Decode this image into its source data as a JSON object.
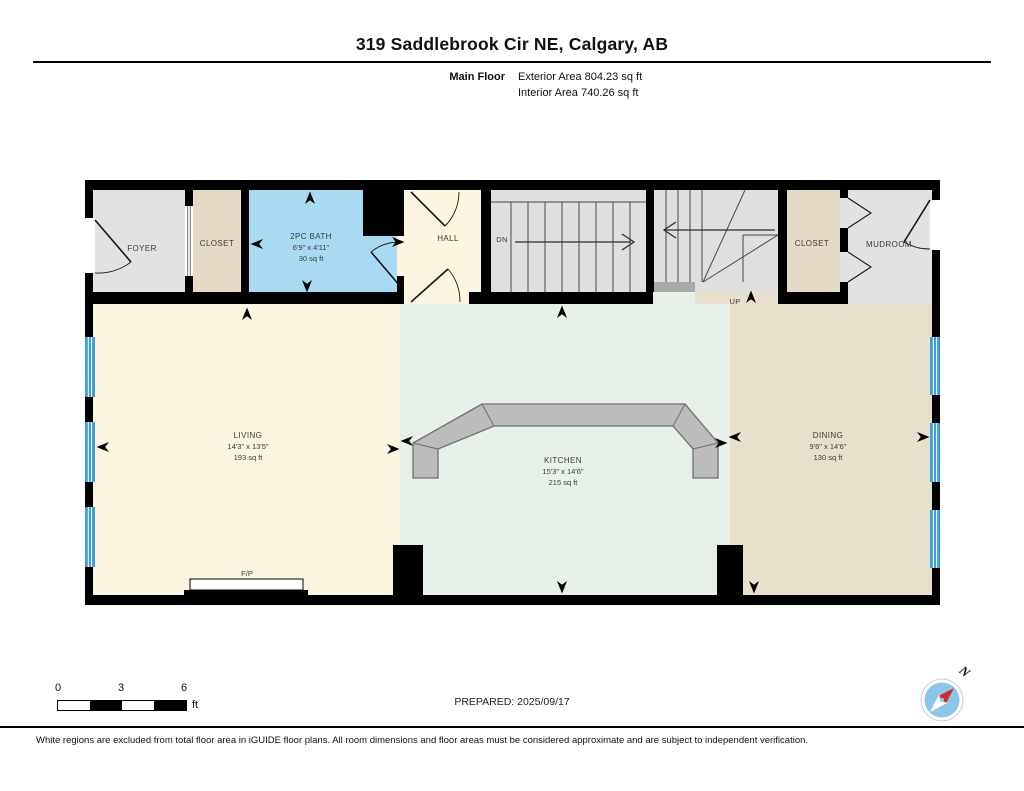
{
  "header": {
    "title": "319 Saddlebrook Cir NE, Calgary, AB",
    "floor_label": "Main Floor",
    "exterior_area": "Exterior Area 804.23 sq ft",
    "interior_area": "Interior Area 740.26 sq ft"
  },
  "rooms": {
    "foyer": {
      "label": "FOYER"
    },
    "closet_left": {
      "label": "CLOSET"
    },
    "bath": {
      "label": "2PC BATH",
      "dims": "6'9\" x 4'11\"",
      "area": "30 sq ft"
    },
    "hall": {
      "label": "HALL"
    },
    "stairs_down": {
      "label": "DN"
    },
    "stairs_up": {
      "label": "UP"
    },
    "closet_right": {
      "label": "CLOSET"
    },
    "mudroom": {
      "label": "MUDROOM"
    },
    "living": {
      "label": "LIVING",
      "dims": "14'3\" x 13'5\"",
      "area": "193 sq ft"
    },
    "kitchen": {
      "label": "KITCHEN",
      "dims": "15'3\" x 14'6\"",
      "area": "215 sq ft"
    },
    "dining": {
      "label": "DINING",
      "dims": "9'6\" x 14'6\"",
      "area": "130 sq ft"
    },
    "fireplace": {
      "label": "F/P"
    }
  },
  "scale_bar": {
    "ticks": [
      "0",
      "3",
      "6"
    ],
    "unit": "ft"
  },
  "footer": {
    "prepared": "PREPARED: 2025/09/17",
    "compass_north": "N",
    "disclaimer": "White regions are excluded from total floor area in iGUIDE floor plans. All room dimensions and floor areas must be considered approximate and are subject to independent verification."
  },
  "colors": {
    "wall": "#000000",
    "room_gray": "#e2e2e2",
    "closet_tan": "#e5dac5",
    "dining_tan": "#e9e0cb",
    "bath_blue": "#a8daf3",
    "cream": "#fcf5df",
    "kitchen_mint": "#e7f1ea",
    "stair_gray": "#dfdfdf",
    "window_blue": "#3f9ed6",
    "counter_gray": "#bcbcbc",
    "compass_blue": "#8ac6ea",
    "compass_red": "#d42a28"
  }
}
